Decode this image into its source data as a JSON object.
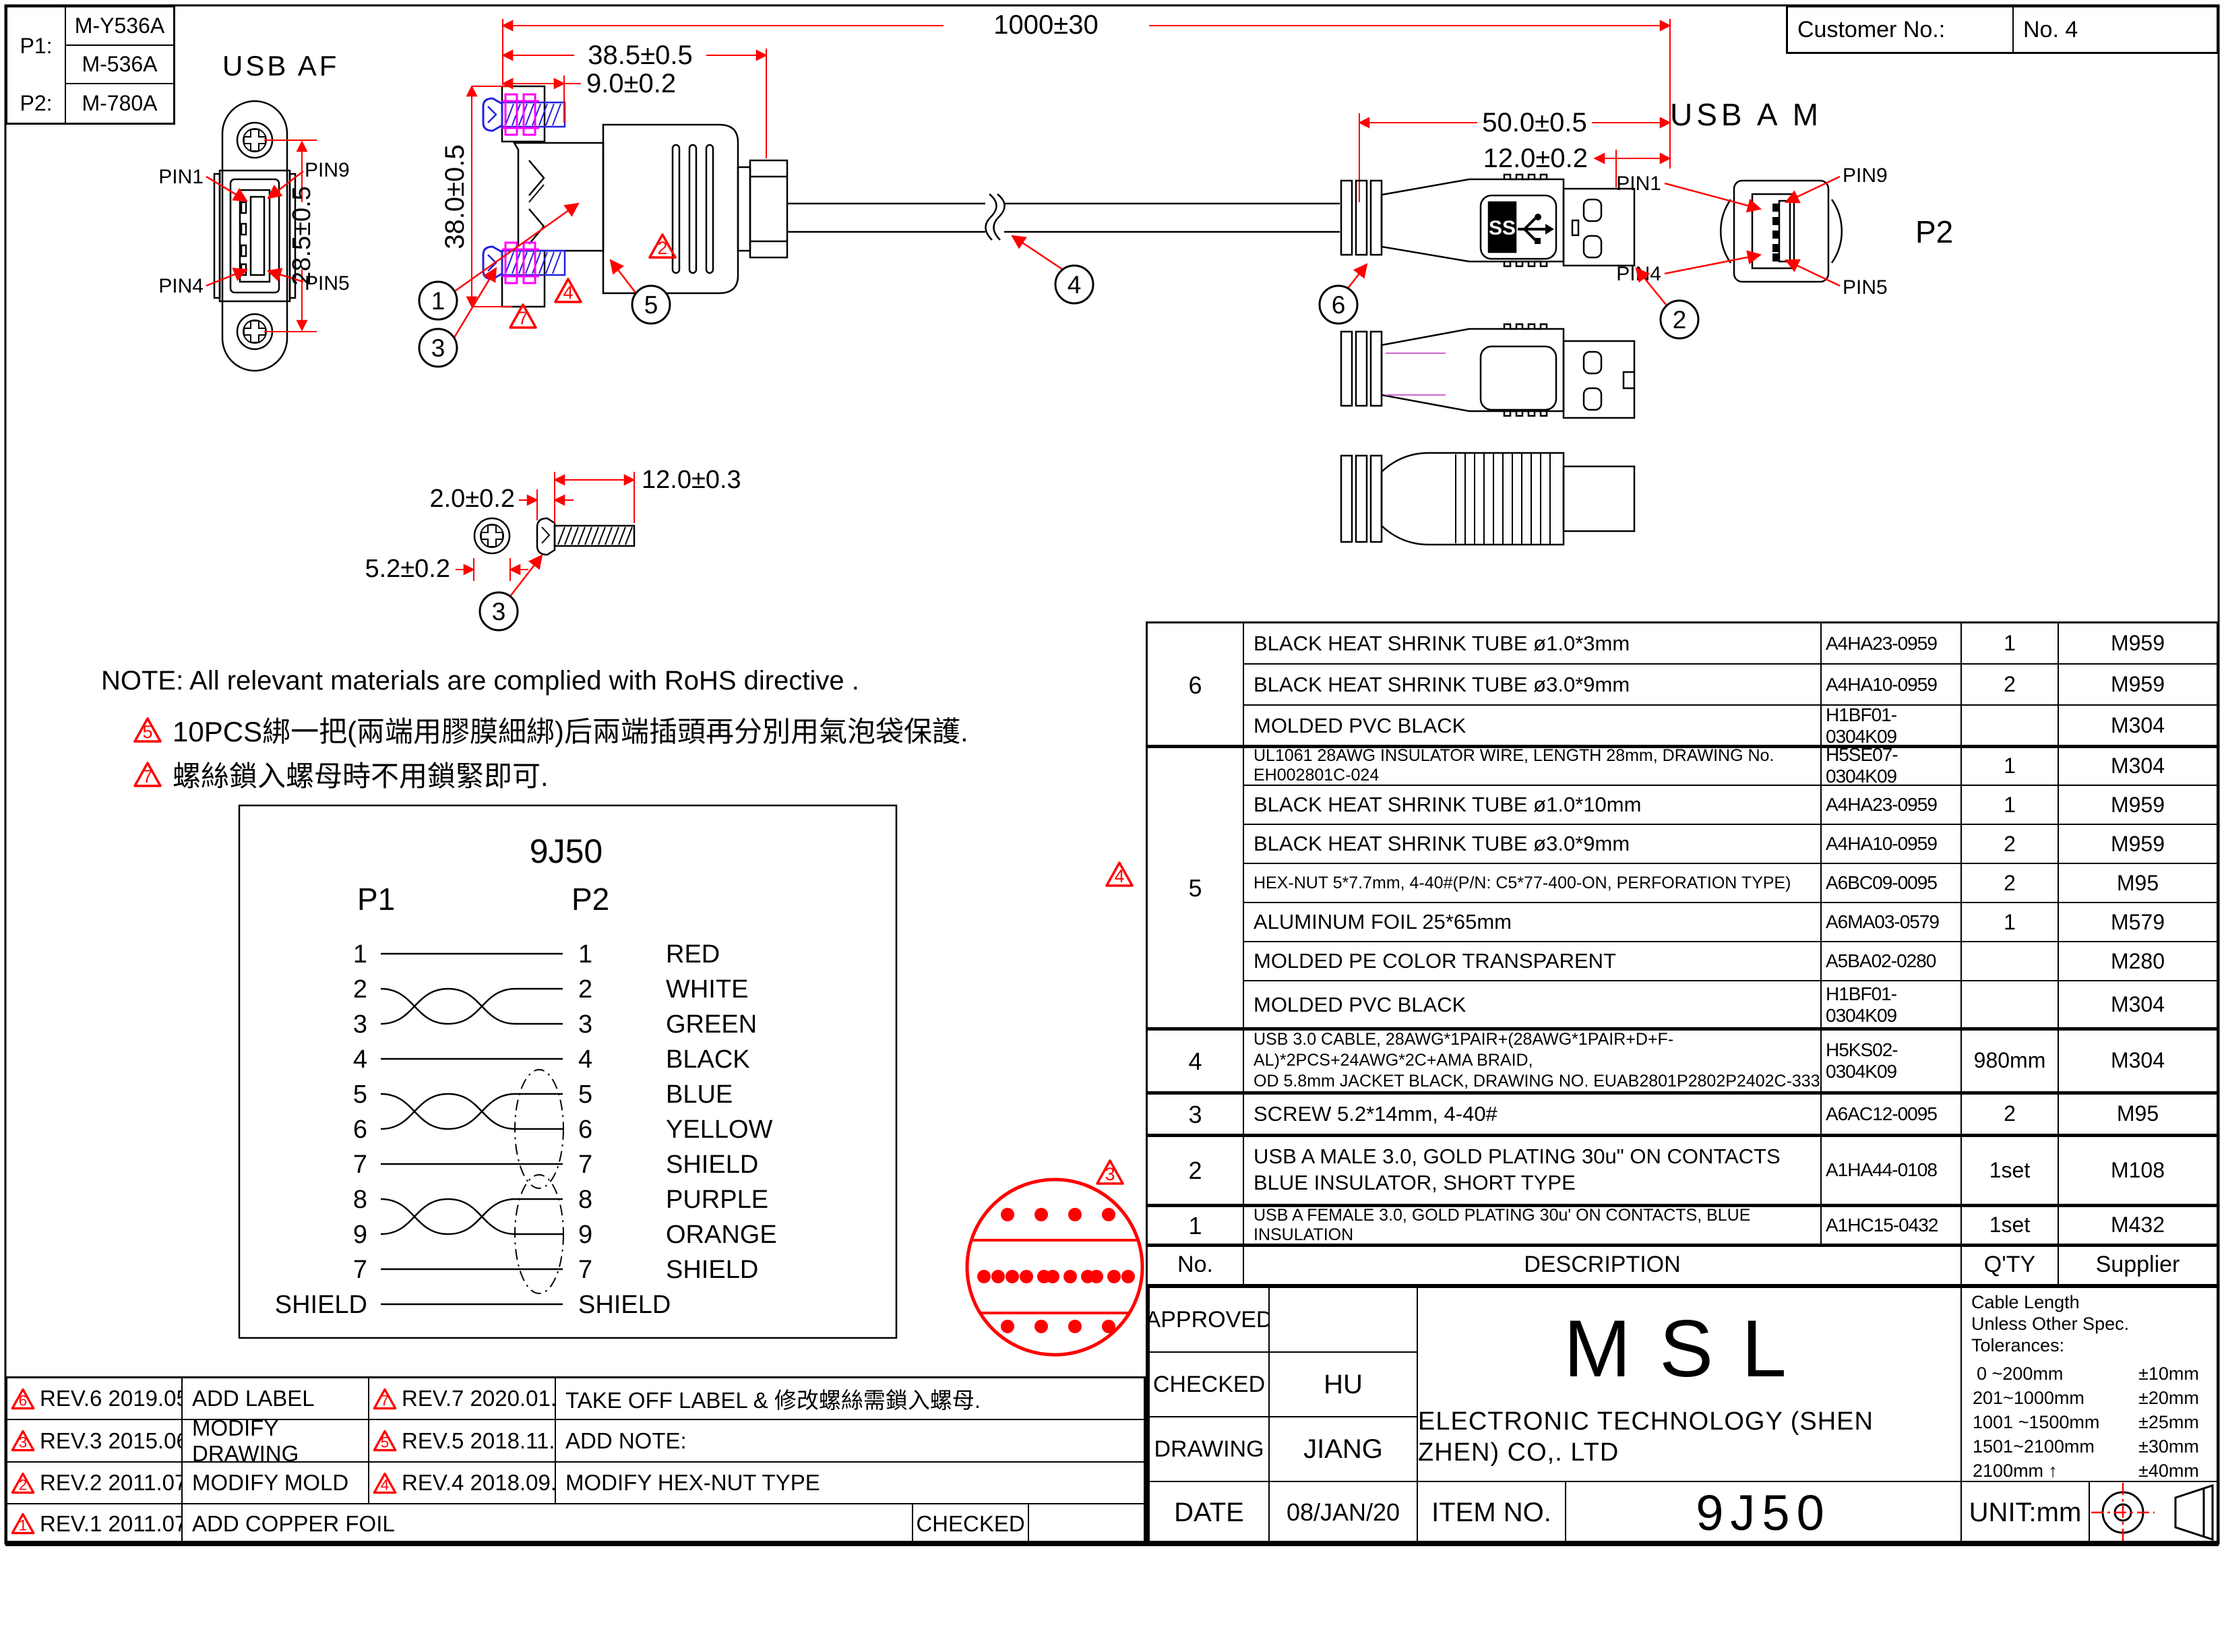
{
  "header": {
    "p1_label": "P1:",
    "p1_model_a": "M-Y536A",
    "p1_model_b": "M-536A",
    "p2_label": "P2:",
    "p2_model": "M-780A",
    "customer_label": "Customer No.:",
    "customer_value": "No. 4"
  },
  "views": {
    "usb_af_label": "USB AF",
    "usb_am_label": "USB A M",
    "p2_front_label": "P2",
    "pins": {
      "pin1": "PIN1",
      "pin9": "PIN9",
      "pin4": "PIN4",
      "pin5": "PIN5"
    }
  },
  "dims": {
    "overall": "1000±30",
    "af_width": "38.5±0.5",
    "af_panel": "9.0±0.2",
    "af_height": "38.0±0.5",
    "af_front_height": "28.5±0.5",
    "am_length": "50.0±0.5",
    "am_shell": "12.0±0.2",
    "screw_head_len": "2.0±0.2",
    "screw_len": "12.0±0.3",
    "screw_head_dia": "5.2±0.2"
  },
  "callouts": {
    "c1": "1",
    "c2": "2",
    "c3": "3",
    "c4": "4",
    "c5": "5",
    "c6": "6"
  },
  "triangles": {
    "t2": "2",
    "t3": "3",
    "t4": "4",
    "t5": "5",
    "t7": "7"
  },
  "notes": {
    "title": "NOTE:  All relevant materials are complied with RoHS directive .",
    "item1": "10PCS綁一把(兩端用膠膜細綁)后兩端插頭再分別用氣泡袋保護.",
    "item2": "螺絲鎖入螺母時不用鎖緊即可."
  },
  "wiring": {
    "title": "9J50",
    "p1": "P1",
    "p2": "P2",
    "rows": [
      {
        "p1": "1",
        "p2": "1",
        "color": "RED"
      },
      {
        "p1": "2",
        "p2": "2",
        "color": "WHITE"
      },
      {
        "p1": "3",
        "p2": "3",
        "color": "GREEN"
      },
      {
        "p1": "4",
        "p2": "4",
        "color": "BLACK"
      },
      {
        "p1": "5",
        "p2": "5",
        "color": "BLUE"
      },
      {
        "p1": "6",
        "p2": "6",
        "color": "YELLOW"
      },
      {
        "p1": "7",
        "p2": "7",
        "color": "SHIELD"
      },
      {
        "p1": "8",
        "p2": "8",
        "color": "PURPLE"
      },
      {
        "p1": "9",
        "p2": "9",
        "color": "ORANGE"
      },
      {
        "p1": "7",
        "p2": "7",
        "color": "SHIELD"
      },
      {
        "p1": "SHIELD",
        "p2": "SHIELD",
        "color": ""
      }
    ]
  },
  "bom": {
    "headers": {
      "no": "No.",
      "description": "DESCRIPTION",
      "qty": "Q'TY",
      "supplier": "Supplier"
    },
    "group_labels": [
      "6",
      "5",
      "4",
      "3",
      "2",
      "1"
    ],
    "rows": [
      {
        "desc": "BLACK HEAT SHRINK TUBE ø1.0*3mm",
        "pn": "A4HA23-0959",
        "qty": "1",
        "sup": "M959"
      },
      {
        "desc": "BLACK HEAT SHRINK TUBE ø3.0*9mm",
        "pn": "A4HA10-0959",
        "qty": "2",
        "sup": "M959"
      },
      {
        "desc": "MOLDED PVC BLACK",
        "pn": "H1BF01-0304K09",
        "qty": "",
        "sup": "M304"
      },
      {
        "desc": "UL1061 28AWG INSULATOR WIRE, LENGTH 28mm, DRAWING No. EH002801C-024",
        "pn": "H5SE07-0304K09",
        "qty": "1",
        "sup": "M304"
      },
      {
        "desc": "BLACK HEAT SHRINK TUBE ø1.0*10mm",
        "pn": "A4HA23-0959",
        "qty": "1",
        "sup": "M959"
      },
      {
        "desc": "BLACK HEAT SHRINK TUBE ø3.0*9mm",
        "pn": "A4HA10-0959",
        "qty": "2",
        "sup": "M959"
      },
      {
        "desc": "HEX-NUT 5*7.7mm, 4-40#(P/N: C5*77-400-ON, PERFORATION TYPE)",
        "pn": "A6BC09-0095",
        "qty": "2",
        "sup": "M95"
      },
      {
        "desc": "ALUMINUM FOIL 25*65mm",
        "pn": "A6MA03-0579",
        "qty": "1",
        "sup": "M579"
      },
      {
        "desc": "MOLDED PE COLOR TRANSPARENT",
        "pn": "A5BA02-0280",
        "qty": "",
        "sup": "M280"
      },
      {
        "desc": "MOLDED PVC BLACK",
        "pn": "H1BF01-0304K09",
        "qty": "",
        "sup": "M304"
      },
      {
        "desc": "USB 3.0 CABLE, 28AWG*1PAIR+(28AWG*1PAIR+D+F-AL)*2PCS+24AWG*2C+AMA BRAID,",
        "desc2": "OD 5.8mm JACKET BLACK, DRAWING NO. EUAB2801P2802P2402C-333",
        "pn": "H5KS02-0304K09",
        "qty": "980mm",
        "sup": "M304"
      },
      {
        "desc": "SCREW 5.2*14mm, 4-40#",
        "pn": "A6AC12-0095",
        "qty": "2",
        "sup": "M95"
      },
      {
        "desc": "USB A MALE 3.0, GOLD PLATING 30u\" ON CONTACTS",
        "desc2": "BLUE INSULATOR, SHORT TYPE",
        "pn": "A1HA44-0108",
        "qty": "1set",
        "sup": "M108"
      },
      {
        "desc": "USB A FEMALE 3.0, GOLD PLATING 30u' ON CONTACTS, BLUE INSULATION",
        "pn": "A1HC15-0432",
        "qty": "1set",
        "sup": "M432"
      }
    ]
  },
  "title_block": {
    "approved_label": "APPROVED",
    "approved": "",
    "checked_label": "CHECKED",
    "checked": "HU",
    "drawing_label": "DRAWING",
    "drawing": "JIANG",
    "date_label": "DATE",
    "date": "08/JAN/20",
    "company_name": "MSL",
    "company_sub": "ELECTRONIC TECHNOLOGY (SHEN ZHEN) CO,. LTD",
    "item_no_label": "ITEM NO.",
    "item_no": "9J50",
    "unit": "UNIT:mm",
    "tolerance": {
      "line1": "Cable Length",
      "line2": "Unless Other Spec.",
      "line3": "Tolerances:",
      "rows": [
        [
          "0 ~200mm",
          "±10mm"
        ],
        [
          "201~1000mm",
          "±20mm"
        ],
        [
          "1001 ~1500mm",
          "±25mm"
        ],
        [
          "1501~2100mm",
          "±30mm"
        ],
        [
          "2100mm ↑",
          "±40mm"
        ]
      ]
    }
  },
  "revisions": {
    "rows": [
      {
        "badge": "6",
        "rev": "REV.6  2019.05.16",
        "desc": "ADD LABEL",
        "badge2": "7",
        "rev2": "REV.7  2020.01.08",
        "desc2": "TAKE OFF LABEL & 修改螺絲需鎖入螺母."
      },
      {
        "badge": "3",
        "rev": "REV.3  2015.06.12",
        "desc": "MODIFY DRAWING",
        "badge2": "5",
        "rev2": "REV.5  2018.11.16",
        "desc2": "ADD NOTE:"
      },
      {
        "badge": "2",
        "rev": "REV.2  2011.07.21",
        "desc": "MODIFY MOLD",
        "badge2": "4",
        "rev2": "REV.4  2018.09.10",
        "desc2": "MODIFY HEX-NUT TYPE"
      }
    ],
    "last_row": {
      "badge": "1",
      "rev": "REV.1  2011.07.07",
      "desc": "ADD COPPER FOIL",
      "checked": "CHECKED"
    }
  },
  "colors": {
    "accent_red": "#ff0000",
    "screw_blue": "#2222dd",
    "nut_magenta": "#ff00ff",
    "pink_line": "#cc66cc"
  }
}
